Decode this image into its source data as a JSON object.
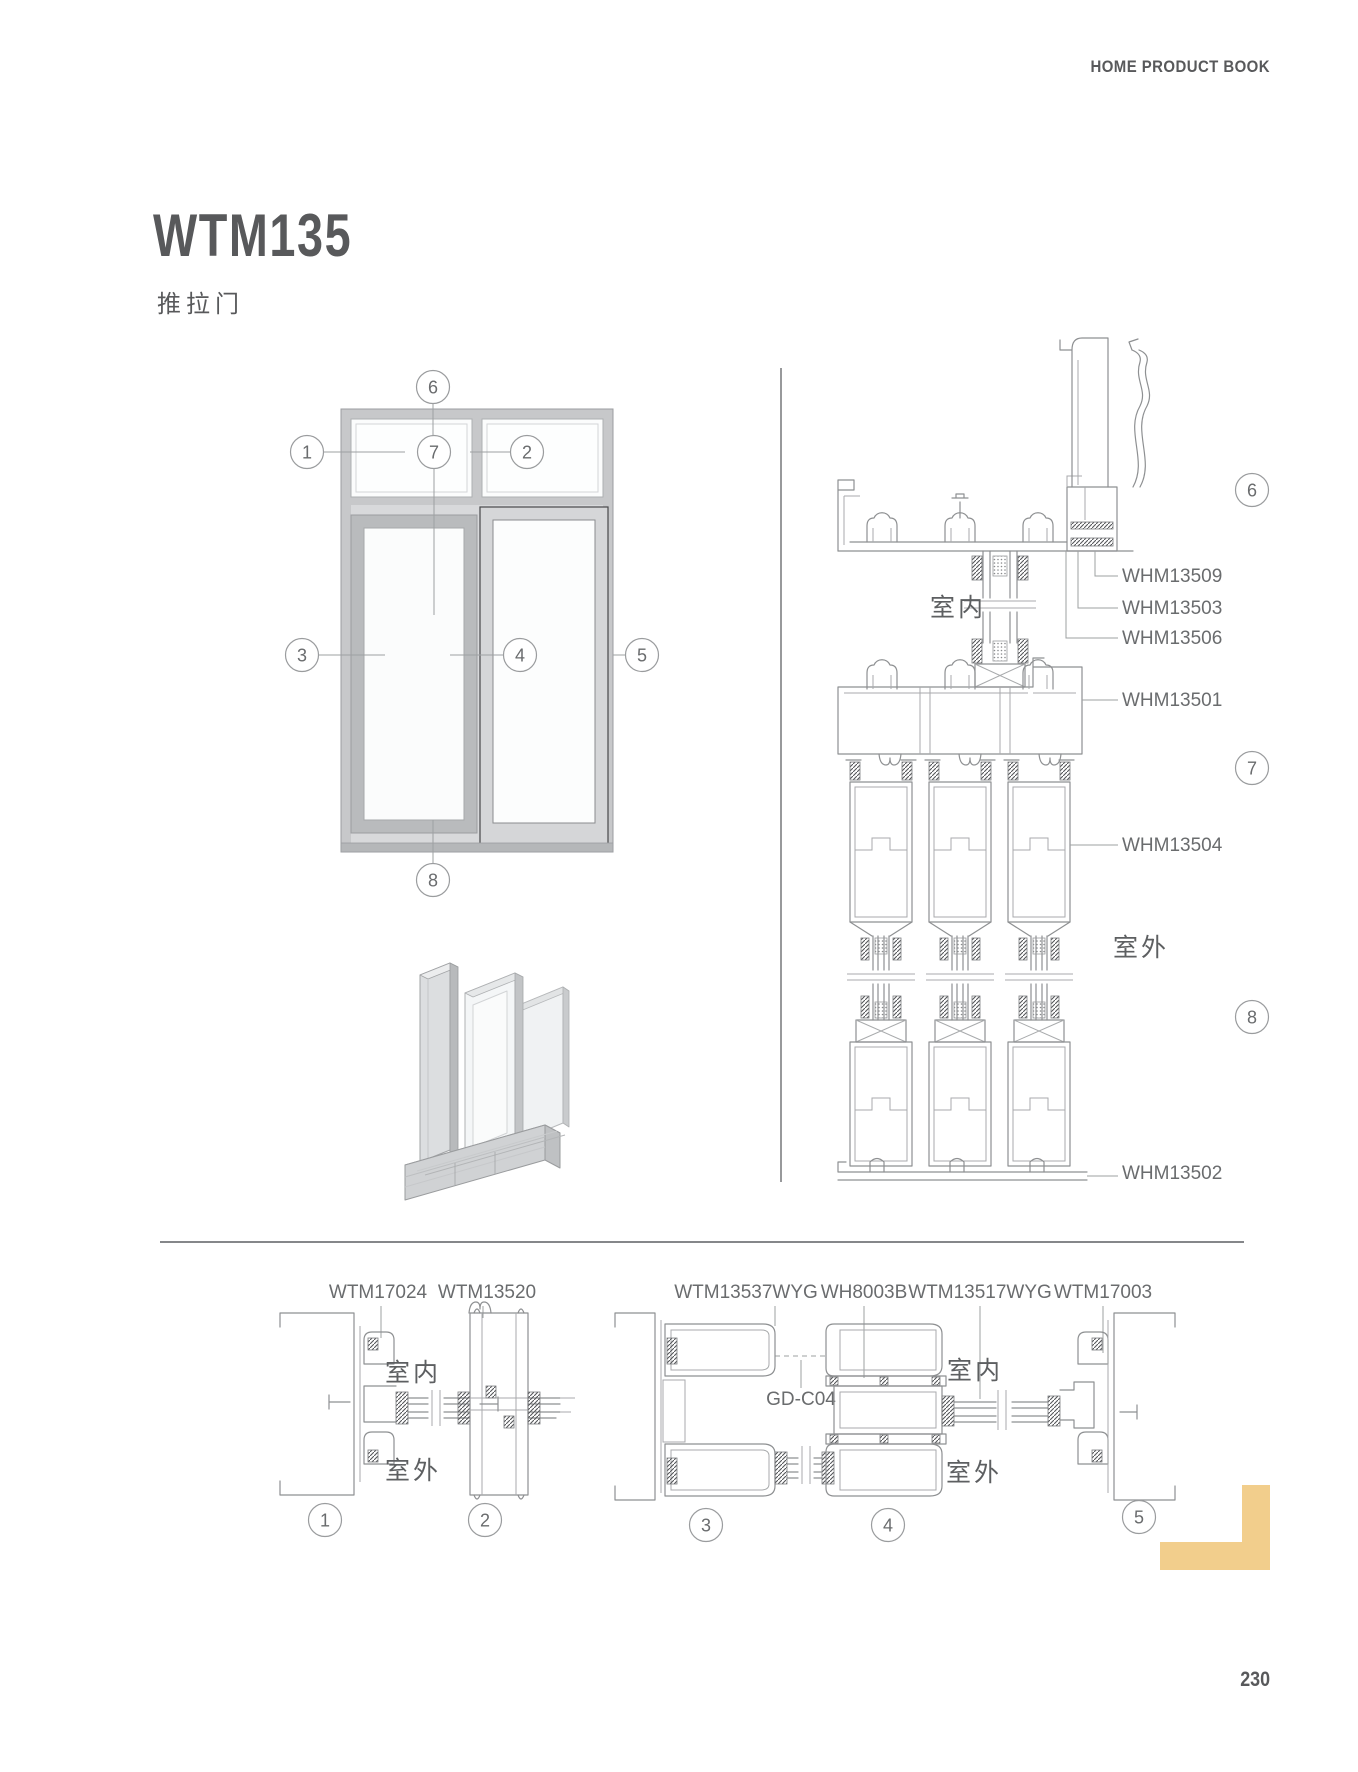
{
  "header": {
    "title": "HOME PRODUCT BOOK"
  },
  "product": {
    "model": "WTM135",
    "category": "推拉门"
  },
  "elevation": {
    "callouts": [
      "1",
      "2",
      "3",
      "4",
      "5",
      "6",
      "7",
      "8"
    ]
  },
  "vertical_section": {
    "indoor": "室内",
    "outdoor": "室外",
    "callouts": [
      "6",
      "7",
      "8"
    ],
    "parts": [
      "WHM13509",
      "WHM13503",
      "WHM13506",
      "WHM13501",
      "WHM13504",
      "WHM13502"
    ]
  },
  "horizontal_sections": {
    "left": {
      "parts": [
        "WTM17024",
        "WTM13520"
      ],
      "indoor": "室内",
      "outdoor": "室外",
      "callouts": [
        "1",
        "2"
      ]
    },
    "right": {
      "parts": [
        "WTM13537WYG",
        "WH8003B",
        "WTM13517WYG",
        "WTM17003"
      ],
      "accessory": "GD-C04",
      "indoor": "室内",
      "outdoor": "室外",
      "callouts": [
        "3",
        "4",
        "5"
      ]
    }
  },
  "footer": {
    "page_number": "230"
  },
  "colors": {
    "accent": "#F2CE8C",
    "heading": "#58595B",
    "line": "#8E9092",
    "label": "#6A6C6E"
  }
}
